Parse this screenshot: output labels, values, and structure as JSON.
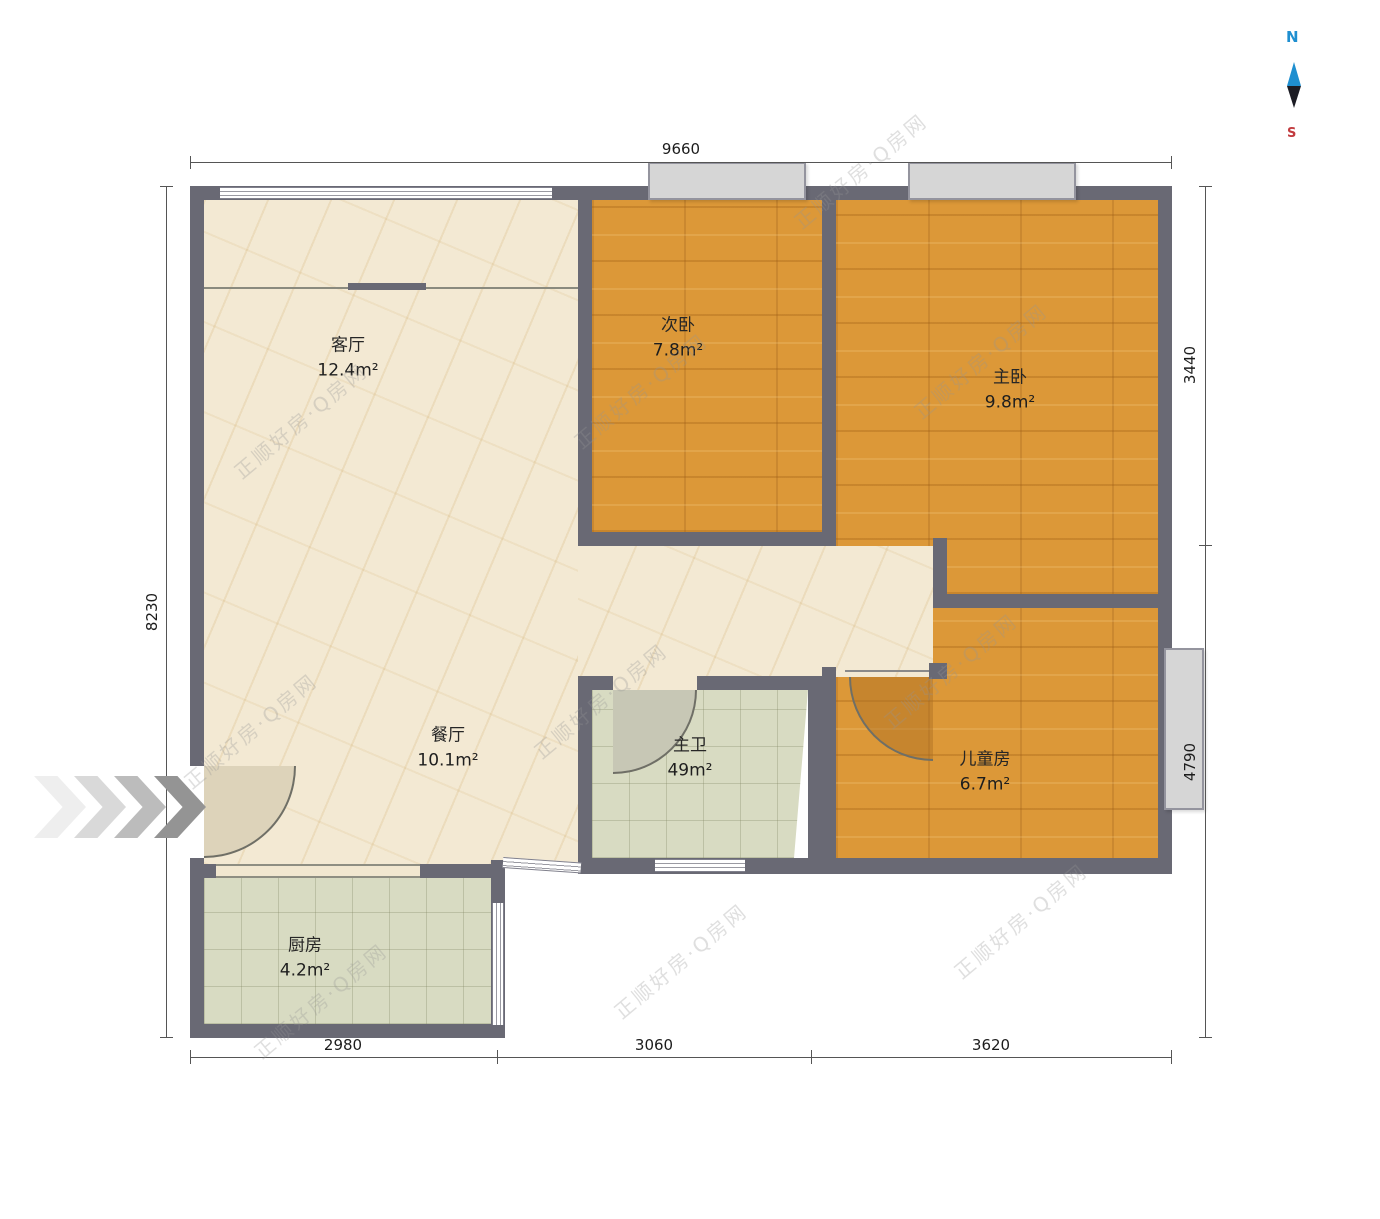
{
  "plan": {
    "rooms": [
      {
        "name": "客厅",
        "area": "12.4m²"
      },
      {
        "name": "次卧",
        "area": "7.8m²"
      },
      {
        "name": "主卧",
        "area": "9.8m²"
      },
      {
        "name": "餐厅",
        "area": "10.1m²"
      },
      {
        "name": "主卫",
        "area": "49m²"
      },
      {
        "name": "儿童房",
        "area": "6.7m²"
      },
      {
        "name": "厨房",
        "area": "4.2m²"
      }
    ],
    "dimensions": {
      "top": "9660",
      "left": "8230",
      "right_upper": "3440",
      "right_lower": "4790",
      "bottom_left": "2980",
      "bottom_center": "3060",
      "bottom_right": "3620"
    },
    "compass": {
      "north": "N",
      "south": "S"
    },
    "watermark": "正顺好房·Q房网",
    "palette": {
      "wall": "#696974",
      "wood_floor": "#dc9838",
      "marble_floor": "#f3e9d3",
      "tile_floor": "#d8dbc2",
      "window_fill": "#d6d6d6",
      "compass_north": "#1f8fd0",
      "compass_south": "#c23b3f"
    }
  }
}
